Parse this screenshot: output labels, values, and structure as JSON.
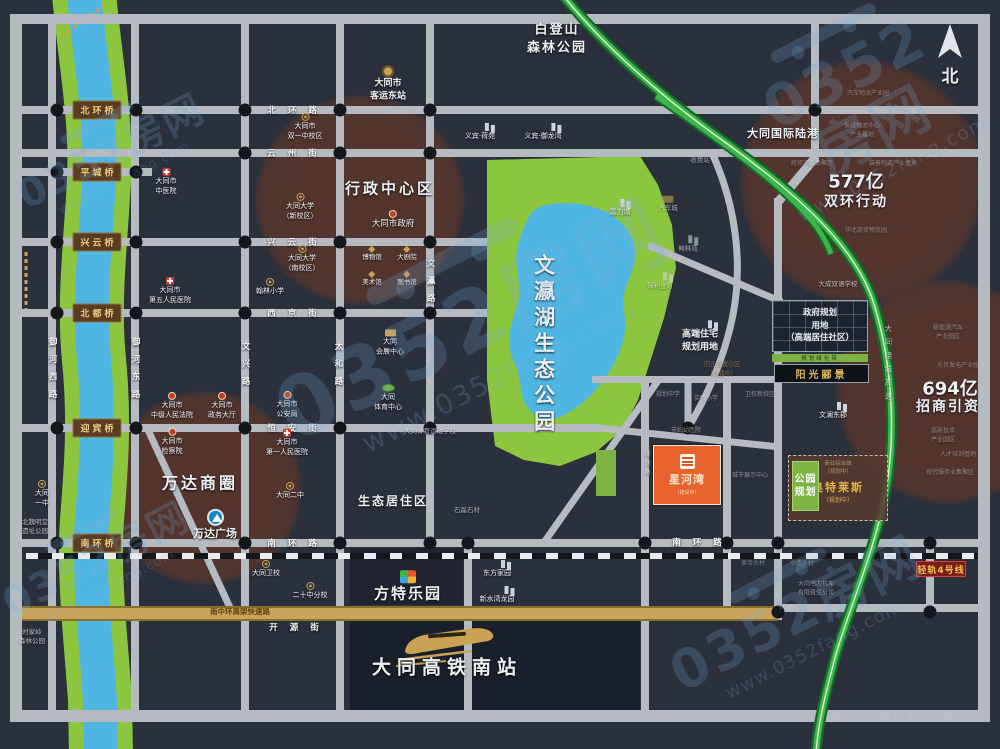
{
  "compass": {
    "label": "北"
  },
  "disclaimer": {
    "text": "本区位示意图仅供参考，最终以政府规划为准"
  },
  "watermark": {
    "brand": "0352房网",
    "url": "www.0352fang.com",
    "positions": [
      {
        "x": 110,
        "y": 150,
        "s": 1.0
      },
      {
        "x": 470,
        "y": 318,
        "s": 2.1
      },
      {
        "x": 858,
        "y": 100,
        "s": 1.45
      },
      {
        "x": 95,
        "y": 558,
        "s": 1.0
      },
      {
        "x": 795,
        "y": 612,
        "s": 1.35
      }
    ]
  },
  "colors": {
    "background": "#2a303c",
    "road": "#b6bbc2",
    "river_bank": "#8cc63e",
    "river_water": "#4fb6e3",
    "park": "#8cc63e",
    "circle": "#54352d",
    "expressway": "#3cb54a",
    "gold_road": "#c9a45c",
    "project_orange": "#e8622d",
    "plaque_brown": "#5a3c22",
    "gold_text": "#d8b45e",
    "rail_badge_red": "#7d1b1b"
  },
  "blocks": [
    [
      350,
      548,
      113,
      57,
      0.55
    ],
    [
      350,
      616,
      290,
      96,
      0.75
    ]
  ],
  "circles": [
    {
      "name": "xingzheng-center",
      "cx": 360,
      "cy": 200,
      "r": 105
    },
    {
      "name": "wanda-circle",
      "cx": 205,
      "cy": 488,
      "r": 97
    },
    {
      "name": "shuanghuan-577",
      "cx": 862,
      "cy": 182,
      "r": 122
    },
    {
      "name": "zhaoshang-694",
      "cx": 948,
      "cy": 392,
      "r": 112
    }
  ],
  "roads": {
    "h": [
      [
        10,
        14,
        980,
        10
      ],
      [
        10,
        710,
        980,
        12
      ],
      [
        20,
        106,
        960,
        8
      ],
      [
        20,
        149,
        960,
        8
      ],
      [
        20,
        168,
        132,
        8
      ],
      [
        20,
        238,
        467,
        8
      ],
      [
        20,
        309,
        467,
        8
      ],
      [
        20,
        424,
        580,
        8
      ],
      [
        20,
        539,
        960,
        8
      ],
      [
        592,
        376,
        192,
        7
      ],
      [
        777,
        604,
        203,
        8
      ]
    ],
    "v": [
      [
        10,
        14,
        12,
        708
      ],
      [
        978,
        14,
        12,
        708
      ],
      [
        48,
        20,
        8,
        692
      ],
      [
        131,
        20,
        8,
        692
      ],
      [
        241,
        20,
        8,
        692
      ],
      [
        336,
        20,
        8,
        692
      ],
      [
        426,
        20,
        8,
        523
      ],
      [
        464,
        539,
        8,
        173
      ],
      [
        641,
        376,
        8,
        336
      ],
      [
        723,
        376,
        8,
        236
      ],
      [
        774,
        198,
        8,
        422
      ],
      [
        811,
        20,
        8,
        142
      ],
      [
        926,
        539,
        8,
        73
      ]
    ],
    "gold": {
      "x": 22,
      "y": 606,
      "w": 756,
      "h": 15
    },
    "rail": {
      "x": 26,
      "y": 553,
      "w": 952
    }
  },
  "dots": [
    [
      57,
      110
    ],
    [
      136,
      110
    ],
    [
      57,
      172
    ],
    [
      136,
      172
    ],
    [
      57,
      242
    ],
    [
      136,
      242
    ],
    [
      57,
      313
    ],
    [
      136,
      313
    ],
    [
      57,
      428
    ],
    [
      136,
      428
    ],
    [
      57,
      543
    ],
    [
      136,
      543
    ],
    [
      245,
      110
    ],
    [
      340,
      110
    ],
    [
      430,
      110
    ],
    [
      815,
      110
    ],
    [
      245,
      153
    ],
    [
      340,
      153
    ],
    [
      430,
      153
    ],
    [
      245,
      242
    ],
    [
      340,
      242
    ],
    [
      430,
      242
    ],
    [
      245,
      313
    ],
    [
      340,
      313
    ],
    [
      430,
      313
    ],
    [
      245,
      428
    ],
    [
      340,
      428
    ],
    [
      430,
      428
    ],
    [
      688,
      428
    ],
    [
      245,
      543
    ],
    [
      340,
      543
    ],
    [
      430,
      543
    ],
    [
      468,
      543
    ],
    [
      645,
      543
    ],
    [
      727,
      543
    ],
    [
      778,
      543
    ],
    [
      930,
      543
    ],
    [
      778,
      612
    ],
    [
      930,
      612
    ]
  ],
  "bridges": {
    "x": 97,
    "items": [
      {
        "name": "北环桥",
        "y": 110
      },
      {
        "name": "平城桥",
        "y": 172
      },
      {
        "name": "兴云桥",
        "y": 242
      },
      {
        "name": "北都桥",
        "y": 313
      },
      {
        "name": "迎宾桥",
        "y": 428
      },
      {
        "name": "南环桥",
        "y": 543
      }
    ]
  },
  "street_labels": [
    {
      "t": "北环路",
      "x": 298,
      "y": 110
    },
    {
      "t": "云州街",
      "x": 298,
      "y": 153
    },
    {
      "t": "兴云街",
      "x": 298,
      "y": 242
    },
    {
      "t": "西京街",
      "x": 298,
      "y": 313
    },
    {
      "t": "恒安街",
      "x": 298,
      "y": 428
    },
    {
      "t": "南环路",
      "x": 298,
      "y": 543
    },
    {
      "t": "南环路",
      "x": 703,
      "y": 542
    },
    {
      "t": "开源街",
      "x": 300,
      "y": 627
    },
    {
      "t": "御河西路",
      "x": 52,
      "y": 372,
      "v": 1
    },
    {
      "t": "御河东路",
      "x": 135,
      "y": 372,
      "v": 1
    },
    {
      "t": "文兴路",
      "x": 245,
      "y": 368,
      "v": 1
    },
    {
      "t": "太和路",
      "x": 338,
      "y": 368,
      "v": 1
    },
    {
      "t": "文瀛路",
      "x": 430,
      "y": 285,
      "v": 1
    }
  ],
  "features": [
    {
      "kind": "grid-box",
      "name": "gov-plan-box",
      "x": 772,
      "y": 300,
      "w": 96,
      "h": 52,
      "lines": [
        "政府规划",
        "用地",
        "（高端居住社区）"
      ]
    },
    {
      "kind": "green-strip",
      "name": "green-belt",
      "x": 772,
      "y": 354,
      "w": 96,
      "h": 8,
      "text": "规划绿化带"
    },
    {
      "kind": "dark-plaque",
      "name": "sunshine-box",
      "x": 774,
      "y": 364,
      "w": 95,
      "h": 19,
      "text": "阳光郦景"
    },
    {
      "kind": "green-strip",
      "name": "park-strip",
      "x": 596,
      "y": 450,
      "w": 20,
      "h": 46,
      "text": ""
    },
    {
      "kind": "dashed-box",
      "name": "outlets-box",
      "x": 788,
      "y": 455,
      "w": 100,
      "h": 66,
      "lines": [
        "商业综合体",
        "（规划中）"
      ],
      "title": "奥特莱斯",
      "sub": "（规划中）"
    },
    {
      "kind": "park-box",
      "name": "park-plan-box",
      "x": 792,
      "y": 461,
      "w": 27,
      "h": 50,
      "lines": [
        "公园",
        "规划"
      ]
    },
    {
      "kind": "orange-box",
      "name": "project-box",
      "x": 653,
      "y": 445,
      "w": 68,
      "h": 60,
      "title": "星河湾",
      "sub": "（建设中）"
    },
    {
      "kind": "rail-plaque",
      "name": "rail-badge",
      "x": 916,
      "y": 561,
      "w": 50,
      "h": 16,
      "text": "轻轨4号线"
    }
  ],
  "pois": [
    {
      "x": 305,
      "y": 127,
      "ic": "school",
      "t": [
        "大同市",
        "双一中校区"
      ]
    },
    {
      "x": 166,
      "y": 182,
      "ic": "hospital",
      "t": [
        "大同市",
        "中医院"
      ]
    },
    {
      "x": 300,
      "y": 207,
      "ic": "school",
      "t": [
        "大同大学",
        "（新校区）"
      ]
    },
    {
      "x": 302,
      "y": 259,
      "ic": "school",
      "t": [
        "大同大学",
        "（南校区）"
      ]
    },
    {
      "x": 270,
      "y": 287,
      "ic": "school",
      "t": [
        "翰林小学"
      ]
    },
    {
      "x": 170,
      "y": 291,
      "ic": "hospital",
      "t": [
        "大同市",
        "第五人民医院"
      ]
    },
    {
      "x": 388,
      "y": 84,
      "ic": "bus",
      "t": [
        "大同市",
        "客运东站"
      ],
      "s": 9,
      "b": 1
    },
    {
      "x": 480,
      "y": 132,
      "ic": "building",
      "t": [
        "义宾·荷苑"
      ]
    },
    {
      "x": 543,
      "y": 132,
      "ic": "building",
      "t": [
        "义宾·御龙湾"
      ]
    },
    {
      "x": 620,
      "y": 208,
      "ic": "building",
      "t": [
        "富力城"
      ]
    },
    {
      "x": 668,
      "y": 204,
      "ic": "expo",
      "t": [
        "汽车城"
      ],
      "s": 6.5,
      "o": 0.6
    },
    {
      "x": 700,
      "y": 160,
      "t": [
        "收费站"
      ],
      "s": 6.5,
      "o": 0.55
    },
    {
      "x": 688,
      "y": 244,
      "ic": "building",
      "t": [
        "翰林苑"
      ],
      "s": 6.5,
      "o": 0.6
    },
    {
      "x": 660,
      "y": 281,
      "ic": "building",
      "t": [
        "保利金町"
      ],
      "s": 6.5,
      "o": 0.6
    },
    {
      "x": 390,
      "y": 343,
      "ic": "expo",
      "t": [
        "大同",
        "会展中心"
      ]
    },
    {
      "x": 388,
      "y": 398,
      "ic": "stadium",
      "t": [
        "大同",
        "体育中心"
      ]
    },
    {
      "x": 430,
      "y": 431,
      "t": [
        "大同体育运动学校"
      ],
      "s": 6.5,
      "o": 0.7
    },
    {
      "x": 172,
      "y": 406,
      "ic": "gov",
      "t": [
        "大同市",
        "中级人民法院"
      ]
    },
    {
      "x": 222,
      "y": 406,
      "ic": "gov",
      "t": [
        "大同市",
        "政务大厅"
      ]
    },
    {
      "x": 287,
      "y": 405,
      "ic": "gov",
      "t": [
        "大同市",
        "公安局"
      ]
    },
    {
      "x": 287,
      "y": 443,
      "ic": "hospital",
      "t": [
        "大同市",
        "第一人民医院"
      ]
    },
    {
      "x": 172,
      "y": 442,
      "ic": "gov",
      "t": [
        "大同市",
        "检察院"
      ]
    },
    {
      "x": 290,
      "y": 491,
      "ic": "school",
      "t": [
        "大同二中"
      ]
    },
    {
      "x": 266,
      "y": 569,
      "ic": "school",
      "t": [
        "大同卫校"
      ]
    },
    {
      "x": 310,
      "y": 591,
      "ic": "school",
      "t": [
        "二十中分校"
      ]
    },
    {
      "x": 497,
      "y": 569,
      "ic": "building",
      "t": [
        "东方家园"
      ]
    },
    {
      "x": 497,
      "y": 595,
      "ic": "building",
      "t": [
        "新水湾龙园"
      ]
    },
    {
      "x": 467,
      "y": 510,
      "t": [
        "石磊石材"
      ],
      "s": 6.5,
      "o": 0.6
    },
    {
      "x": 42,
      "y": 494,
      "ic": "school",
      "t": [
        "大同",
        "一中"
      ]
    },
    {
      "x": 35,
      "y": 527,
      "t": [
        "北魏明堂",
        "遗址公园"
      ],
      "s": 6.5,
      "o": 0.7
    },
    {
      "x": 32,
      "y": 637,
      "t": [
        "时家岭",
        "森林公园"
      ],
      "s": 6.5,
      "o": 0.7
    },
    {
      "x": 557,
      "y": 40,
      "t": [
        "白登山",
        "森林公园"
      ],
      "s": 13,
      "b": 1,
      "ls": 2
    },
    {
      "x": 838,
      "y": 284,
      "t": [
        "大成双语学校"
      ],
      "s": 6.5,
      "o": 0.7
    },
    {
      "x": 833,
      "y": 411,
      "ic": "building",
      "t": [
        "文澜东郡"
      ]
    },
    {
      "x": 700,
      "y": 337,
      "ic": "building",
      "t": [
        "高端住宅",
        "规划用地"
      ],
      "s": 9,
      "b": 1
    },
    {
      "x": 722,
      "y": 370,
      "t": [
        "回迁安置小区",
        "（在建中）"
      ],
      "s": 6,
      "o": 0.5,
      "c": "#cda76a"
    },
    {
      "x": 668,
      "y": 395,
      "t": [
        "规划中学"
      ],
      "s": 6,
      "o": 0.5
    },
    {
      "x": 706,
      "y": 399,
      "t": [
        "实验小学"
      ],
      "s": 6,
      "o": 0.5
    },
    {
      "x": 760,
      "y": 395,
      "t": [
        "卫校新校区"
      ],
      "s": 6,
      "o": 0.5
    },
    {
      "x": 686,
      "y": 431,
      "t": [
        "市妇幼医院"
      ],
      "s": 6,
      "o": 0.5
    },
    {
      "x": 750,
      "y": 476,
      "t": [
        "城市展示中心"
      ],
      "s": 6,
      "o": 0.5
    },
    {
      "x": 393,
      "y": 502,
      "t": [
        "生态居住区"
      ],
      "s": 12,
      "b": 1,
      "ls": 2
    },
    {
      "x": 200,
      "y": 484,
      "t": [
        "万达商圈"
      ],
      "s": 16,
      "b": 1,
      "ls": 3
    },
    {
      "x": 215,
      "y": 525,
      "ic": "wanda",
      "t": [
        "万达广场"
      ],
      "s": 11,
      "b": 1
    },
    {
      "x": 390,
      "y": 189,
      "t": [
        "行政中心区"
      ],
      "s": 15,
      "b": 1,
      "ls": 3
    },
    {
      "x": 393,
      "y": 220,
      "ic": "gov",
      "t": [
        "大同市政府"
      ],
      "s": 8.5
    },
    {
      "x": 372,
      "y": 254,
      "ic": "museum",
      "t": [
        "博物馆"
      ],
      "s": 6.5
    },
    {
      "x": 407,
      "y": 254,
      "ic": "museum",
      "t": [
        "大剧院"
      ],
      "s": 6.5
    },
    {
      "x": 372,
      "y": 279,
      "ic": "museum",
      "t": [
        "美术馆"
      ],
      "s": 6.5
    },
    {
      "x": 407,
      "y": 279,
      "ic": "museum",
      "t": [
        "图书馆"
      ],
      "s": 6.5
    },
    {
      "x": 783,
      "y": 134,
      "t": [
        "大同国际陆港"
      ],
      "s": 11,
      "b": 1,
      "ls": 1
    },
    {
      "x": 868,
      "y": 94,
      "t": [
        "汽车物流产业园"
      ],
      "s": 6,
      "o": 0.4
    },
    {
      "x": 862,
      "y": 131,
      "t": [
        "保税物流中心",
        "产业基地"
      ],
      "s": 6,
      "o": 0.4
    },
    {
      "x": 812,
      "y": 164,
      "t": [
        "经贸产业集聚区"
      ],
      "s": 6,
      "o": 0.4
    },
    {
      "x": 893,
      "y": 164,
      "t": [
        "装备制造产业基地"
      ],
      "s": 6,
      "o": 0.4
    },
    {
      "x": 856,
      "y": 182,
      "t": [
        "577亿"
      ],
      "s": 18,
      "b": 1
    },
    {
      "x": 856,
      "y": 202,
      "t": [
        "双环行动"
      ],
      "s": 14,
      "b": 1,
      "ls": 2
    },
    {
      "x": 866,
      "y": 231,
      "t": [
        "华北商贸物流园"
      ],
      "s": 6,
      "o": 0.4
    },
    {
      "x": 950,
      "y": 389,
      "t": [
        "694亿"
      ],
      "s": 18,
      "b": 1
    },
    {
      "x": 948,
      "y": 407,
      "t": [
        "招商引资"
      ],
      "s": 14,
      "b": 1,
      "ls": 2
    },
    {
      "x": 948,
      "y": 333,
      "t": [
        "新能源汽车",
        "产业园区"
      ],
      "s": 6,
      "o": 0.4
    },
    {
      "x": 958,
      "y": 366,
      "t": [
        "光伏发电产业园"
      ],
      "s": 6,
      "o": 0.4
    },
    {
      "x": 943,
      "y": 436,
      "t": [
        "高新技术",
        "产业园区"
      ],
      "s": 6,
      "o": 0.4
    },
    {
      "x": 958,
      "y": 455,
      "t": [
        "人才培训基地"
      ],
      "s": 6,
      "o": 0.4
    },
    {
      "x": 950,
      "y": 473,
      "t": [
        "现代服务业集聚区"
      ],
      "s": 6,
      "o": 0.4
    },
    {
      "x": 408,
      "y": 587,
      "ic": "fangte",
      "t": [
        "方特乐园"
      ],
      "s": 15,
      "b": 1,
      "ls": 2
    },
    {
      "x": 447,
      "y": 668,
      "t": [
        "大同高铁南站"
      ],
      "s": 19,
      "b": 1,
      "ls": 6
    },
    {
      "x": 240,
      "y": 612,
      "t": [
        "南中环高架快速路"
      ],
      "s": 7.5,
      "b": 1,
      "c": "#5d430f",
      "sh": 0
    },
    {
      "x": 753,
      "y": 564,
      "t": [
        "泉寺头村"
      ],
      "s": 6,
      "o": 0.45
    },
    {
      "x": 802,
      "y": 564,
      "t": [
        "小南头村"
      ],
      "s": 6,
      "o": 0.45
    },
    {
      "x": 816,
      "y": 589,
      "t": [
        "大同电力机车",
        "有限责任公司"
      ],
      "s": 6,
      "o": 0.5
    },
    {
      "x": 543,
      "y": 345,
      "t": [
        "文瀛湖生态公园"
      ],
      "s": 21,
      "b": 1,
      "v": 1,
      "ls": 5
    },
    {
      "x": 646,
      "y": 464,
      "t": [
        "规划路"
      ],
      "s": 6,
      "o": 0.65,
      "v": 1,
      "ls": 3
    },
    {
      "x": 888,
      "y": 365,
      "t": [
        "大同绕城高速"
      ],
      "s": 7.5,
      "o": 0.7,
      "v": 1,
      "ls": 6
    }
  ]
}
